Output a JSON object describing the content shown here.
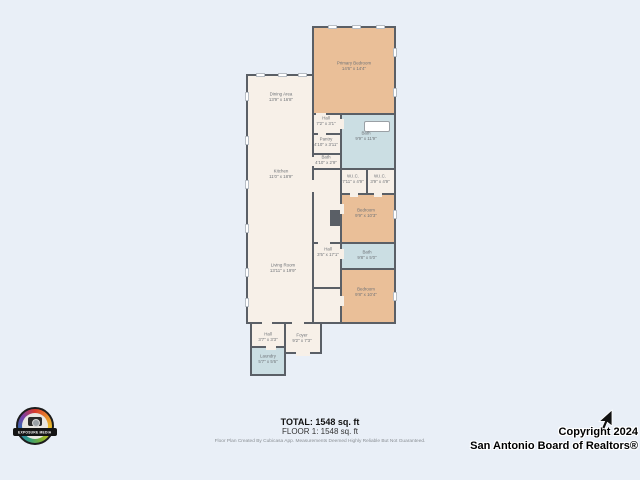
{
  "colors": {
    "background": "#e9eff7",
    "wall": "#5a5f66",
    "floor_fill": "#f7f0e8",
    "bedroom_fill": "#eabf98",
    "bath_fill": "#cbdee3"
  },
  "floorplan": {
    "rooms": [
      {
        "name": "Primary Bedroom",
        "dims": "14'6\" x 14'4\""
      },
      {
        "name": "Dining Area",
        "dims": "13'9\" x 16'8\""
      },
      {
        "name": "Hall",
        "dims": "7'2\" x 3'1\""
      },
      {
        "name": "Pantry",
        "dims": "4'10\" x 3'11\""
      },
      {
        "name": "Bath",
        "dims": "4'10\" x 2'9\""
      },
      {
        "name": "Bath",
        "dims": "9'9\" x 11'9\""
      },
      {
        "name": "Kitchen",
        "dims": "11'0\" x 18'9\""
      },
      {
        "name": "W.I.C.",
        "dims": "7'11\" x 4'9\""
      },
      {
        "name": "W.I.C.",
        "dims": "3'9\" x 4'9\""
      },
      {
        "name": "Bedroom",
        "dims": "9'9\" x 10'3\""
      },
      {
        "name": "Hall",
        "dims": "3'5\" x 17'1\""
      },
      {
        "name": "Bath",
        "dims": "9'8\" x 5'0\""
      },
      {
        "name": "Living Room",
        "dims": "13'11\" x 19'9\""
      },
      {
        "name": "Bedroom",
        "dims": "9'8\" x 10'4\""
      },
      {
        "name": "Hall",
        "dims": "3'7\" x 3'3\""
      },
      {
        "name": "Foyer",
        "dims": "9'2\" x 7'3\""
      },
      {
        "name": "Laundry",
        "dims": "5'7\" x 5'6\""
      }
    ]
  },
  "footer": {
    "total": "TOTAL: 1548 sq. ft",
    "floor": "FLOOR 1: 1548 sq. ft",
    "disclaimer": "Floor Plan Created By Cubicasa App. Measurements Deemed Highly Reliable But Not Guaranteed."
  },
  "watermark": {
    "line1": "Copyright 2024",
    "line2": "San Antonio Board of Realtors®"
  },
  "logo": {
    "brand": "EXPOSURE MEDIA"
  }
}
